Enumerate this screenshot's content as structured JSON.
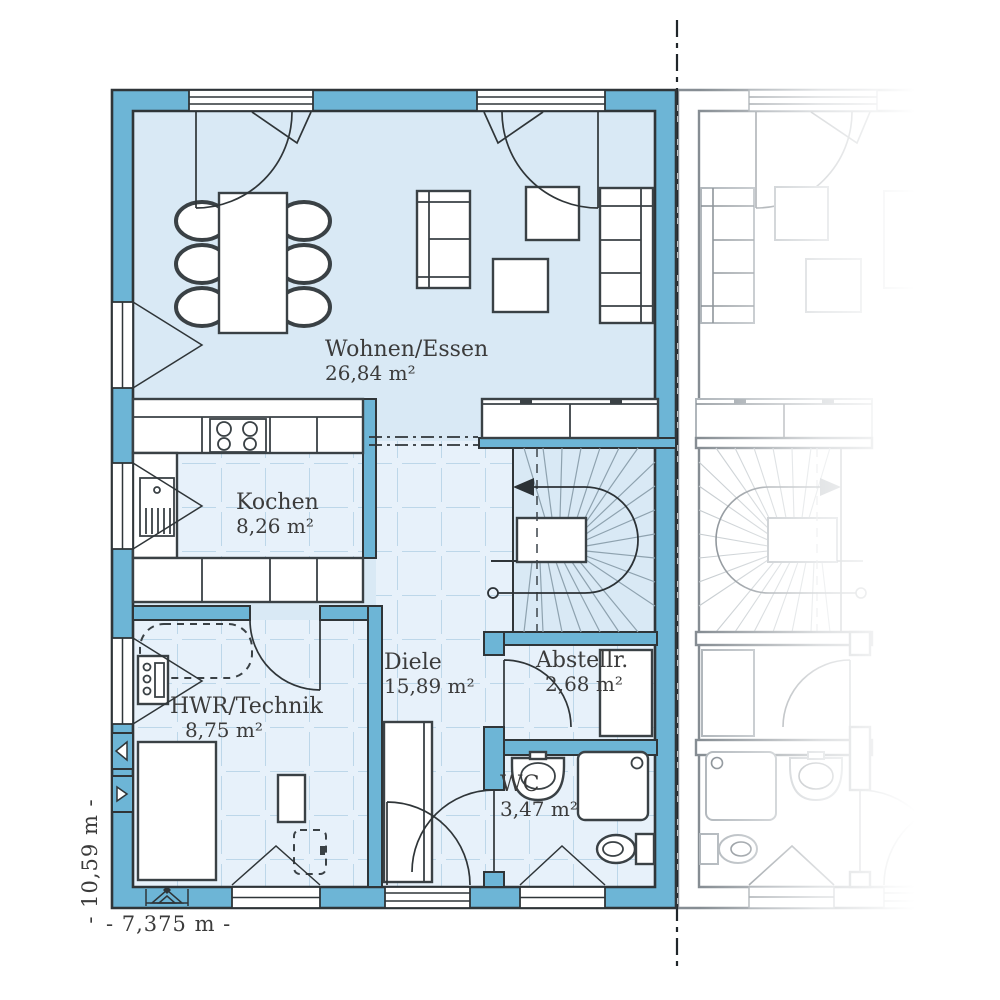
{
  "rooms": {
    "wohnen_essen": {
      "name": "Wohnen/Essen",
      "area": "26,84 m²"
    },
    "kochen": {
      "name": "Kochen",
      "area": "8,26 m²"
    },
    "diele": {
      "name": "Diele",
      "area": "15,89 m²"
    },
    "abstellraum": {
      "name": "Abstellr.",
      "area": "2,68 m²"
    },
    "hwr_technik": {
      "name": "HWR/Technik",
      "area": "8,75 m²"
    },
    "wc": {
      "name": "WC",
      "area": "3,47 m²"
    }
  },
  "dimensions": {
    "total_width": "- 7,375 m -",
    "total_height": "- 10,59 m -"
  },
  "colors": {
    "wall": "#6db5d6",
    "floor": "#d9e9f5",
    "tile_floor": "#e7f1fa",
    "tile_line": "#bdd7e9",
    "outline": "#2f3538",
    "furniture_outline": "#3a4145",
    "label_text": "#3b3b3b",
    "boundary_line": "#20262a",
    "faded_unit": "#9aa1a7"
  }
}
